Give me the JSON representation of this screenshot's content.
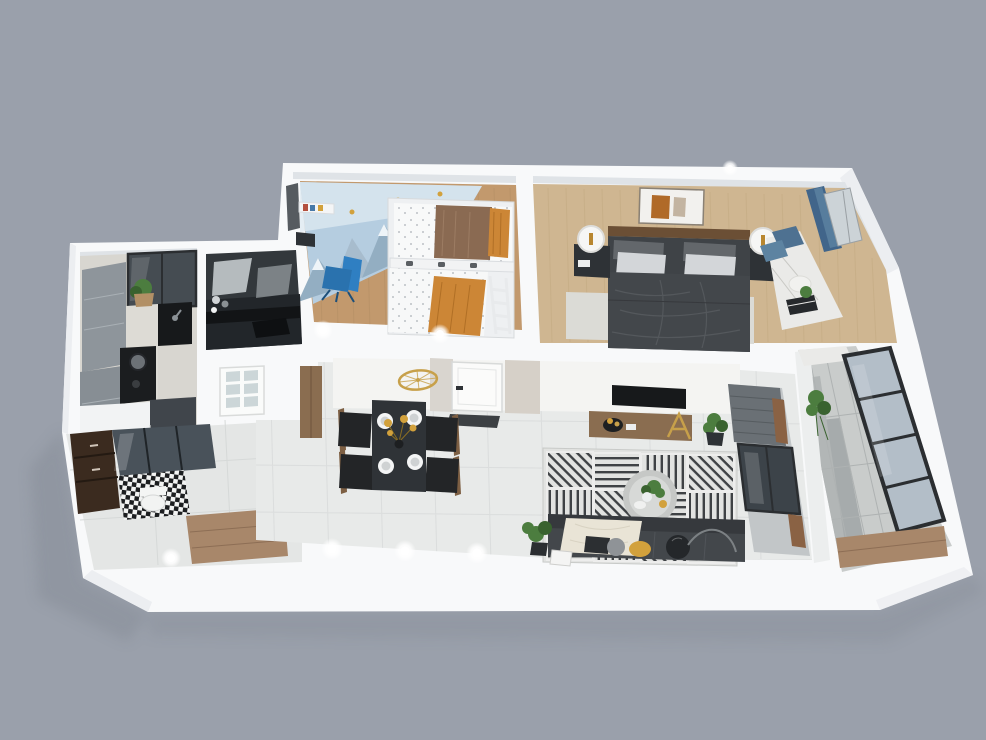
{
  "scene": {
    "type": "3d-floorplan-render",
    "description": "Isometric 3D render of a furnished apartment floor plan on a plain gray backdrop",
    "rooms": [
      {
        "id": "kids-bedroom"
      },
      {
        "id": "master-bedroom"
      },
      {
        "id": "kitchen"
      },
      {
        "id": "study-nook"
      },
      {
        "id": "bathroom-laundry"
      },
      {
        "id": "dining-area"
      },
      {
        "id": "living-room"
      },
      {
        "id": "entry"
      },
      {
        "id": "balcony"
      }
    ],
    "ceiling_lights_visible": 7
  },
  "palette": {
    "background": "#9aa0ab",
    "shadow": "#7f8590",
    "wall": "#f8f9fa",
    "wall_face": "#eceef1",
    "wall_inner": "#dfe3e7",
    "greige": "#d6d0c8",
    "greige_dark": "#c9c2b8",
    "tile": "#e8eae9",
    "tile_seam": "#d7dad9",
    "wood_floor": "#c2996d",
    "wood_floor_light": "#cfb691",
    "plank_seam": "#b28d63",
    "plank_seam_light": "#bfa67e",
    "wood_furniture": "#8a6d50",
    "wood_bench": "#a8876a",
    "charcoal": "#3f4347",
    "graphite": "#2e3236",
    "ink": "#17191b",
    "sofa": "#43474b",
    "sofa_back": "#36393d",
    "cream": "#e9e4d6",
    "yellow": "#d2a13c",
    "gold": "#c7a04a",
    "orange": "#cc8636",
    "brown_blanket": "#8a6a52",
    "kids_blue": "#b5cde0",
    "kids_blue_light": "#dfe9f2",
    "mountain_blue": "#93aec2",
    "mountain_blue_light": "#a7bccd",
    "chair_blue": "#2f7fc2",
    "curtain_blue": "#41658a",
    "curtain_blue_light": "#5d83a1",
    "cabinet_gray": "#8e959b",
    "cabinet_gray_dark": "#878e94",
    "marble": "#d8d6d0",
    "marble_light": "#eaeae8",
    "glass": "#b3bec8",
    "glass_dark": "#49525a",
    "frame_black": "#2b2e31",
    "vanity_brown": "#3b2b1f",
    "plant_green": "#4c7d3f",
    "plant_green_dark": "#39622f",
    "rug_base": "#e2e3e1",
    "rug_ink": "#2e3134",
    "blinds_gray": "#6a7075",
    "pillow_light": "#d3d6d9",
    "pillow_gray": "#8f9397",
    "glow": "#ffffff"
  }
}
